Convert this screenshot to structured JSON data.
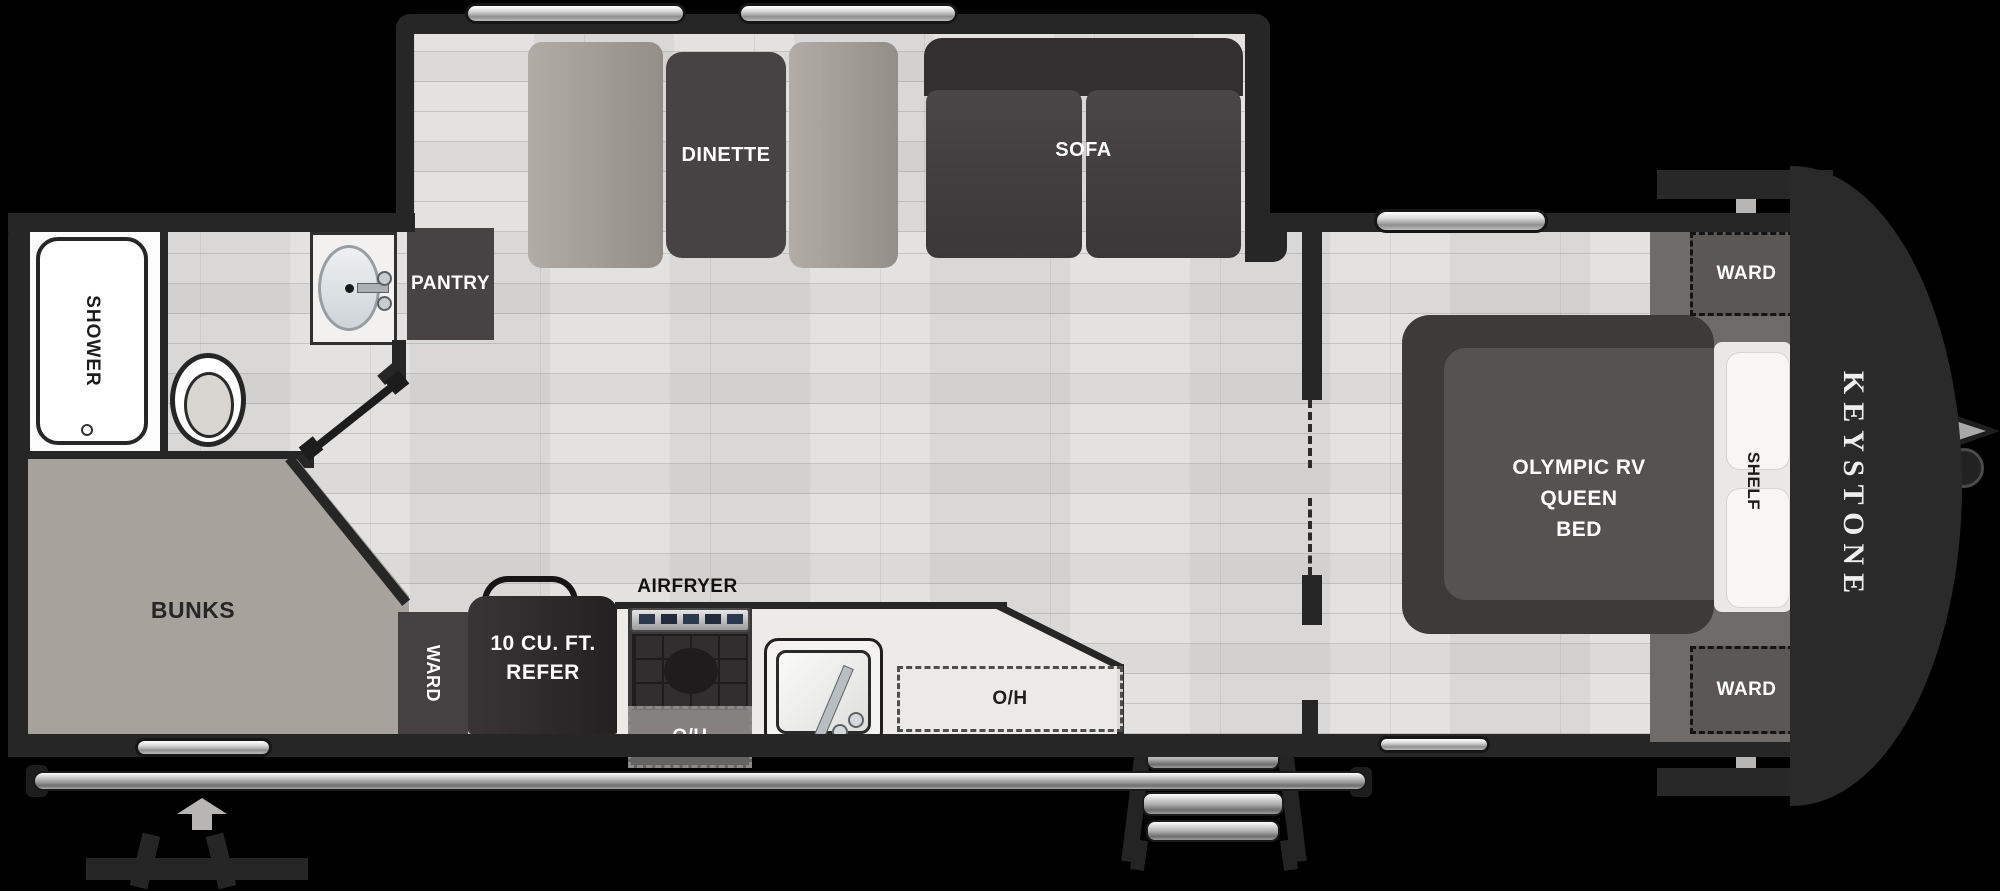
{
  "brand": {
    "logo_text": "KEYSTONE"
  },
  "slideout": {
    "dinette": "DINETTE",
    "sofa": "SOFA"
  },
  "bathroom": {
    "shower": "SHOWER"
  },
  "bunk_room": {
    "bunks": "BUNKS"
  },
  "kitchen": {
    "pantry": "PANTRY",
    "ward": "WARD",
    "refer_line1": "10 CU. FT.",
    "refer_line2": "REFER",
    "airfryer": "AIRFRYER",
    "overhead_above_stove": "O/H",
    "overhead_counter": "O/H"
  },
  "bedroom": {
    "bed_line1": "OLYMPIC RV",
    "bed_line2": "QUEEN",
    "bed_line3": "BED",
    "shelf": "SHELF",
    "ward_front_top": "WARD",
    "ward_front_bottom": "WARD"
  },
  "colors": {
    "background": "#000000",
    "wall": "#262626",
    "floor": "#e3e2e0",
    "dark_furniture": "#474344",
    "sofa": "#433f41",
    "bench": "#a8a29c",
    "bunks": "#a8a29c",
    "cabinet_gray": "#6f6b68",
    "label_white": "#ffffff",
    "label_black": "#1d1d1d"
  }
}
